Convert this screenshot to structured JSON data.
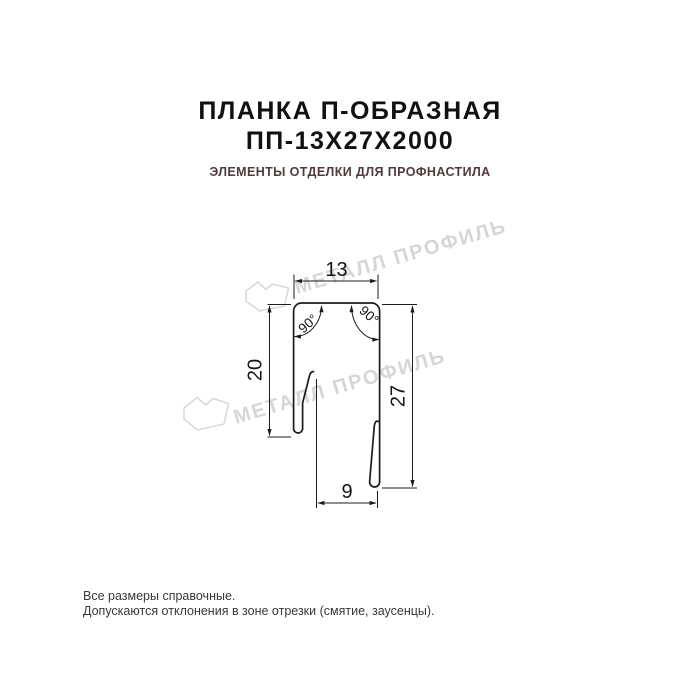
{
  "header": {
    "title_line1": "ПЛАНКА П-ОБРАЗНАЯ",
    "title_line2": "ПП-13Х27Х2000",
    "subtitle": "ЭЛЕМЕНТЫ ОТДЕЛКИ ДЛЯ ПРОФНАСТИЛА"
  },
  "drawing": {
    "dim_top_width": "13",
    "dim_left_height": "20",
    "dim_right_height": "27",
    "dim_bottom_width": "9",
    "angle_left": "90°",
    "angle_right": "90°"
  },
  "watermark": {
    "text": "МЕТАЛЛ ПРОФИЛЬ"
  },
  "footer": {
    "line1": "Все размеры справочные.",
    "line2": "Допускаются отклонения в зоне отрезки (смятие, заусенцы)."
  },
  "colors": {
    "subtitle_text": "#503a3c",
    "drawing_line": "#1c1c1c",
    "watermark": "#d6d6d6",
    "footer_text": "#383838"
  }
}
